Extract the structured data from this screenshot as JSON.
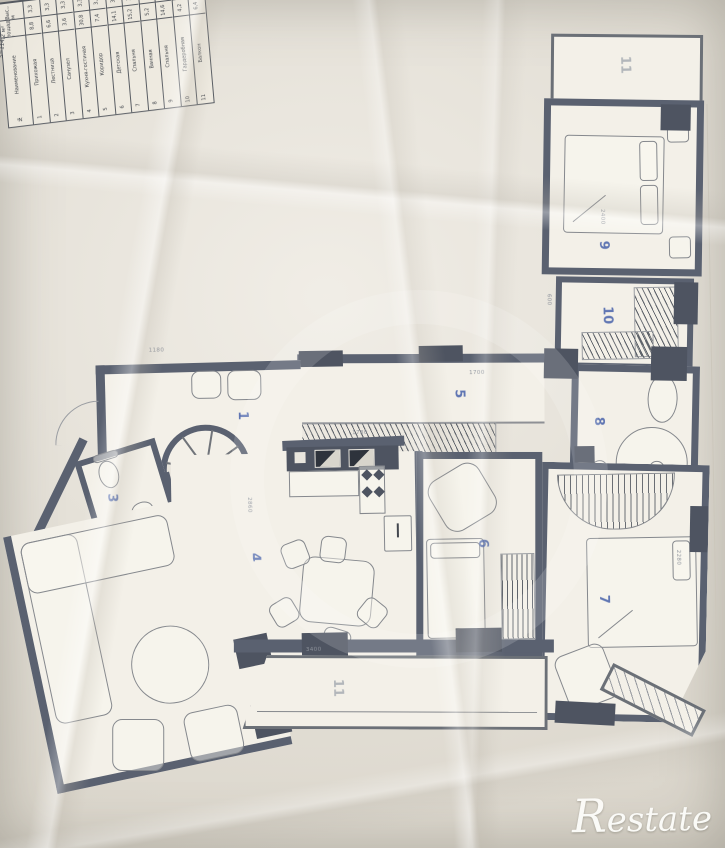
{
  "meta": {
    "brand_watermark": "Restate"
  },
  "colors": {
    "wall": "#5a6170",
    "paper": "#e9e4d9",
    "room_number_accent": "#3c58a6",
    "watermark": "#ffffff"
  },
  "rooms": [
    {
      "id": "entrance-hall",
      "number": "1"
    },
    {
      "id": "spiral-stair",
      "number": "2"
    },
    {
      "id": "wc",
      "number": "3"
    },
    {
      "id": "kitchen-living-room",
      "number": "4"
    },
    {
      "id": "corridor",
      "number": "5"
    },
    {
      "id": "childrens-room",
      "number": "6"
    },
    {
      "id": "bedroom-south",
      "number": "7"
    },
    {
      "id": "bathroom",
      "number": "8"
    },
    {
      "id": "bedroom-north",
      "number": "9"
    },
    {
      "id": "wardrobe",
      "number": "10"
    },
    {
      "id": "balcony-top",
      "number": "11"
    },
    {
      "id": "balcony-bottom",
      "number": "11"
    }
  ],
  "explication": {
    "total_label": "S=114,2 м²",
    "headers": {
      "h": "Выс., м",
      "area": "Площадь, м²",
      "name": "Наименование",
      "num": "№"
    },
    "columns": [
      {
        "num": "1",
        "name": "Прихожая",
        "area": "8,8",
        "h": "3,3"
      },
      {
        "num": "2",
        "name": "Лестница",
        "area": "6,6",
        "h": "3,3"
      },
      {
        "num": "3",
        "name": "Санузел",
        "area": "3,6",
        "h": "3,3"
      },
      {
        "num": "4",
        "name": "Кухня-гостиная",
        "area": "30,8",
        "h": "3,3"
      },
      {
        "num": "5",
        "name": "Коридор",
        "area": "7,4",
        "h": "3,3"
      },
      {
        "num": "6",
        "name": "Детская",
        "area": "14,1",
        "h": "3,3"
      },
      {
        "num": "7",
        "name": "Спальня",
        "area": "15,2",
        "h": "3,3"
      },
      {
        "num": "8",
        "name": "Ванная",
        "area": "5,2",
        "h": "3,3"
      },
      {
        "num": "9",
        "name": "Спальня",
        "area": "14,6",
        "h": "3,3"
      },
      {
        "num": "10",
        "name": "Гардеробная",
        "area": "4,2",
        "h": "3,3"
      },
      {
        "num": "11",
        "name": "Балкон",
        "area": "6,4",
        "h": "2,2"
      }
    ]
  },
  "dims": [
    "2400",
    "2860",
    "1700",
    "1780",
    "3400",
    "2280",
    "1180",
    "600"
  ]
}
